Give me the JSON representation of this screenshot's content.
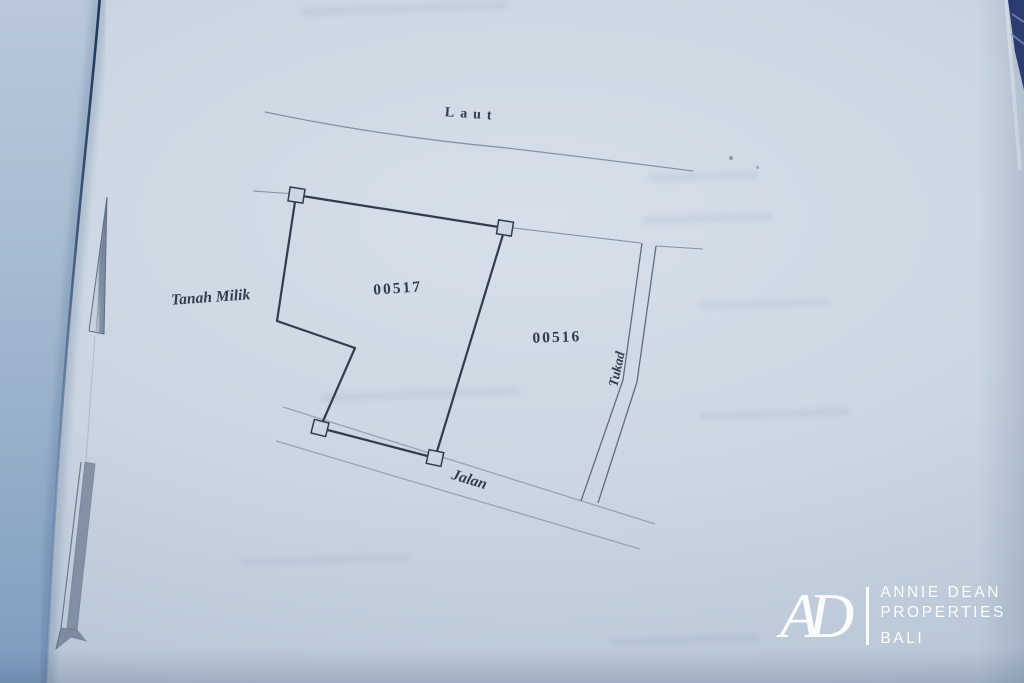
{
  "document": {
    "kind": "land-plot-survey-sketch-photo"
  },
  "map": {
    "labels": {
      "sea": "Laut",
      "owner": "Tanah Milik",
      "plot_main": "00517",
      "plot_adjacent": "00516",
      "river": "Tukad",
      "road": "Jalan"
    }
  },
  "watermark": {
    "monogram": "AD",
    "line1": "ANNIE DEAN",
    "line2": "PROPERTIES",
    "line3": "BALI"
  },
  "colors": {
    "paper": "#c8d3e0",
    "paper-edge": "#a9bacd",
    "ink": "#313c4d",
    "faint": "#8493a6",
    "medium": "#5d6d80",
    "left-page-top": "#b7c7da",
    "left-page-bot": "#7e9cc0",
    "crease": "#2a4568",
    "navy": "#222f69",
    "logo": "#ffffff"
  }
}
